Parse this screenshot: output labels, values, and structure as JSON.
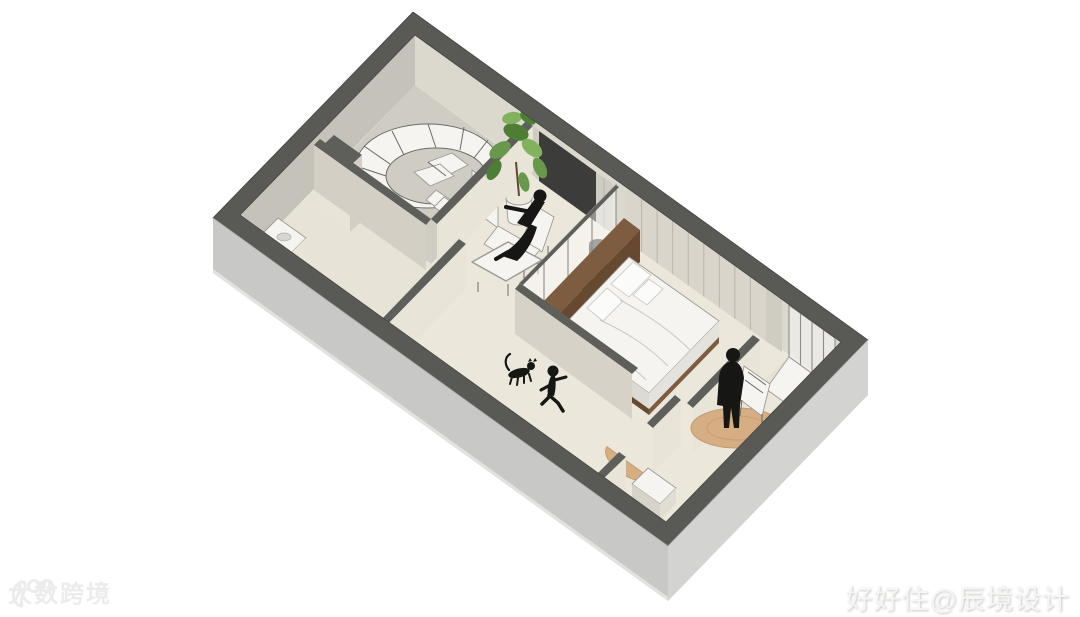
{
  "canvas": {
    "width": 1080,
    "height": 617,
    "background": "#ffffff"
  },
  "scene": {
    "kind": "isometric-interior-floor-plan-rendering",
    "rooms": [
      "stairwell",
      "bathroom",
      "study",
      "bedroom",
      "hallway",
      "entry",
      "balcony"
    ],
    "figures": [
      "seated-person",
      "person-at-desk",
      "standing-person",
      "running-child",
      "cat"
    ],
    "objects": [
      "spiral-staircase",
      "potted-plant",
      "tv-panel",
      "lounge-chair",
      "ottoman",
      "desk-chair",
      "wood-headboard-console",
      "double-bed",
      "wardrobe",
      "fold-out-panel",
      "bathroom-sink",
      "round-rug",
      "half-round-rug",
      "corner-window"
    ]
  },
  "palette": {
    "wall_top": "#595955",
    "exterior_wall": "#c8c8c6",
    "interior_wall": "#d6d2c8",
    "floor": "#ebe7db",
    "wood": "#7d5c3f",
    "rug": "#d6ae84",
    "plant": "#68994a",
    "silhouette": "#161614",
    "furniture_white": "#f5f4f1"
  },
  "watermarks": {
    "bottom_left": {
      "text": "大数跨境",
      "logo": "hand-drawn-100-logo",
      "color": "#ececec"
    },
    "bottom_right": {
      "text": "好好住@辰境设计",
      "color": "#f6f6f4"
    }
  }
}
